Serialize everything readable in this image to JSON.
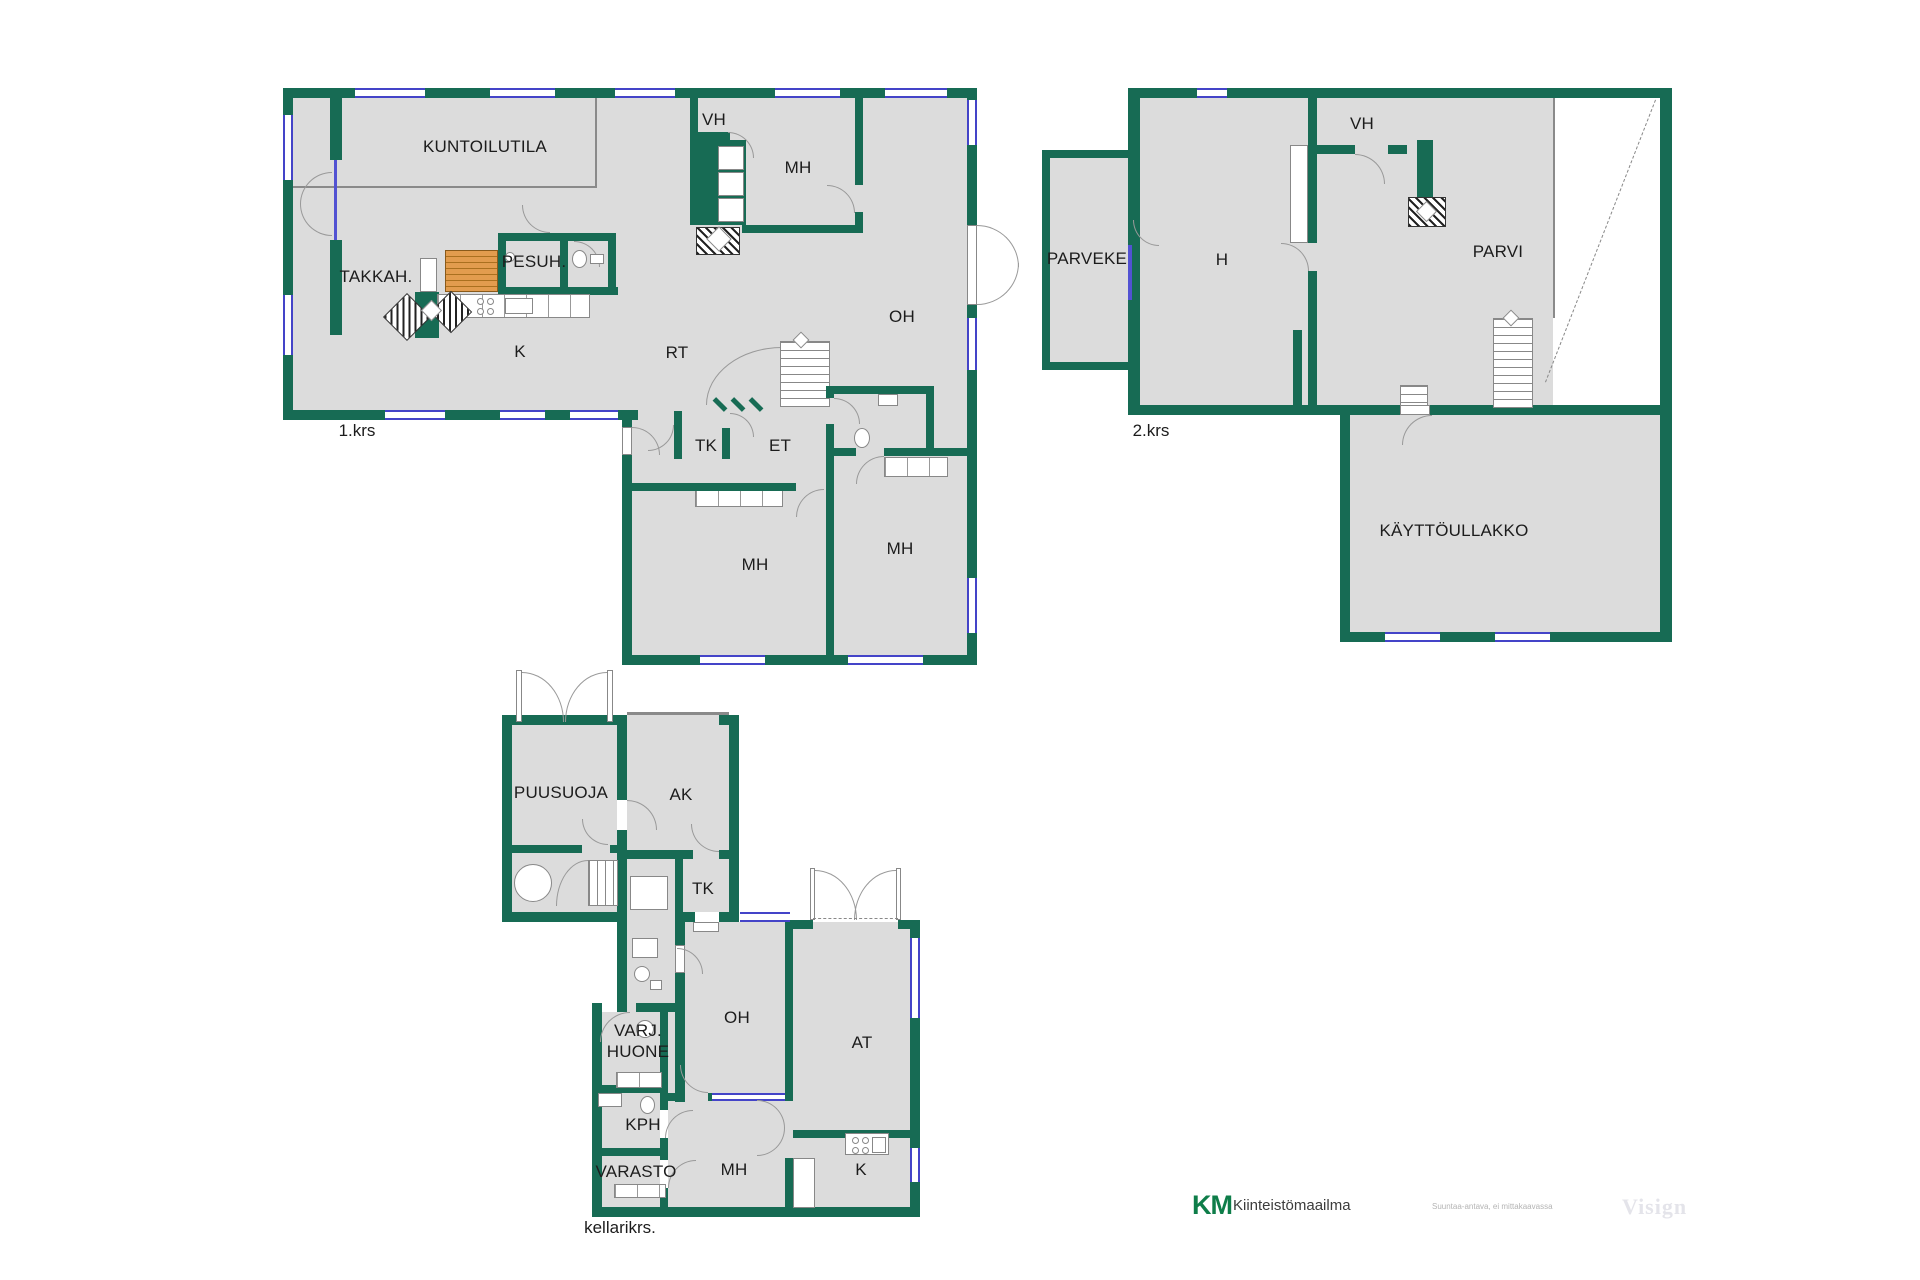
{
  "floors": {
    "floor1": {
      "label": "1.krs",
      "rooms": {
        "kuntoilutila": "KUNTOILUTILA",
        "vh": "VH",
        "mh_top": "MH",
        "takkah": "TAKKAH.",
        "pesuh": "PESUH.",
        "k": "K",
        "rt": "RT",
        "oh": "OH",
        "tk": "TK",
        "et": "ET",
        "mh_left": "MH",
        "mh_right": "MH"
      }
    },
    "floor2": {
      "label": "2.krs",
      "rooms": {
        "parveke": "PARVEKE",
        "h": "H",
        "vh": "VH",
        "parvi": "PARVI",
        "kayttoullakko": "KÄYTTÖULLAKKO"
      }
    },
    "basement": {
      "label": "kellarikrs.",
      "rooms": {
        "puusuoja": "PUUSUOJA",
        "ak": "AK",
        "tk": "TK",
        "oh": "OH",
        "at": "AT",
        "varj_line1": "VARJ.",
        "varj_line2": "HUONE",
        "kph": "KPH",
        "varasto": "VARASTO",
        "mh": "MH",
        "k": "K"
      }
    }
  },
  "footer": {
    "logo_km": "KM",
    "logo_text": "Kiinteistömaailma",
    "disclaimer": "Suuntaa-antava, ei mittakaavassa",
    "watermark": "Visign"
  },
  "colors": {
    "wall": "#176b54",
    "floor_fill": "#dcdcdc",
    "window": "#4444c8",
    "sauna_bench": "#e29c4e"
  }
}
